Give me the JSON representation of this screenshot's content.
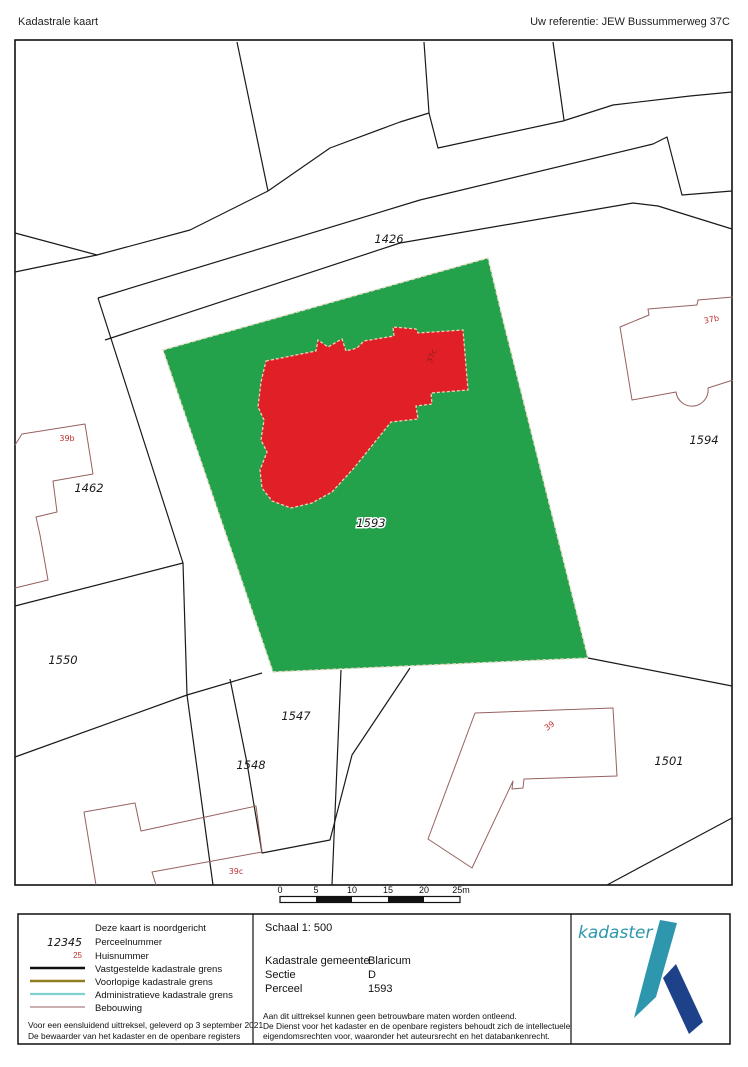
{
  "header": {
    "title": "Kadastrale kaart",
    "reference": "Uw referentie: JEW Bussummerweg 37C"
  },
  "map": {
    "parcels": [
      {
        "label": "1426"
      },
      {
        "label": "1462"
      },
      {
        "label": "1550"
      },
      {
        "label": "1547"
      },
      {
        "label": "1548"
      },
      {
        "label": "1593"
      },
      {
        "label": "1594"
      },
      {
        "label": "1501"
      }
    ],
    "houses": [
      {
        "label": "39b"
      },
      {
        "label": "37b"
      },
      {
        "label": "37c"
      },
      {
        "label": "39"
      },
      {
        "label": "39c"
      }
    ]
  },
  "scalebar": {
    "ticks": [
      "0",
      "5",
      "10",
      "15",
      "20",
      "25m"
    ]
  },
  "legend": {
    "north_note": "Deze kaart is noordgericht",
    "perceel_sample": "12345",
    "perceel_label": "Perceelnummer",
    "huis_sample": "25",
    "huis_label": "Huisnummer",
    "vastgesteld": "Vastgestelde kadastrale grens",
    "voorlopig": "Voorlopige kadastrale grens",
    "administratief": "Administratieve kadastrale grens",
    "bebouwing": "Bebouwing"
  },
  "info": {
    "scale_label": "Schaal 1: 500",
    "gemeente_label": "Kadastrale gemeente",
    "gemeente_value": "Blaricum",
    "sectie_label": "Sectie",
    "sectie_value": "D",
    "perceel_label": "Perceel",
    "perceel_value": "1593"
  },
  "footer": {
    "left_line1": "Voor een eensluidend uittreksel, geleverd op 3 september 2021",
    "left_line2": "De bewaarder van het kadaster en de openbare registers",
    "right_line1": "Aan dit uittreksel kunnen geen betrouwbare maten worden ontleend.",
    "right_line2": "De Dienst voor het kadaster en de openbare registers behoudt zich de intellectuele",
    "right_line3": "eigendomsrechten voor, waaronder het auteursrecht en het databankenrecht."
  },
  "logo": {
    "text": "kadaster"
  },
  "colors": {
    "parcel_green": "#23a24b",
    "building_red": "#e01f26",
    "house_label_red": "#c03030",
    "boundary_black": "#1a1a1a",
    "provisional_olive": "#8f7d1f",
    "administrative_cyan": "#7fd0d0",
    "bebouwing_maroon": "#96615f",
    "logo_teal": "#2e96ad",
    "logo_blue": "#1d4289"
  }
}
